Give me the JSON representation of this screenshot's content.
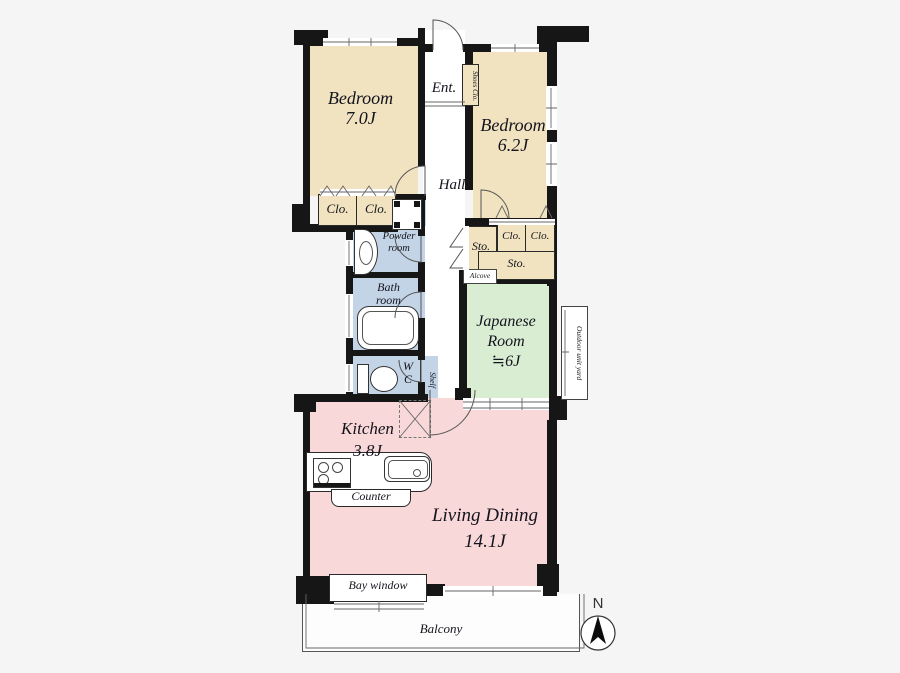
{
  "page": {
    "type": "apartment-floor-plan"
  },
  "colors": {
    "bedroom_beige": "#f1e3c0",
    "wet_area_blue": "#c3d4e6",
    "tatami_green": "#d9edd3",
    "living_pink": "#f8d8d8",
    "wall_black": "#161616",
    "background": "#f5f5f6"
  },
  "labels": {
    "bedroom1_name": "Bedroom",
    "bedroom1_area": "7.0J",
    "bedroom2_name": "Bedroom",
    "bedroom2_area": "6.2J",
    "entrance": "Ent.",
    "shoes_closet": "Shoes Clo.",
    "hall": "Hall",
    "closet": "Clo.",
    "storage": "Sto.",
    "powder_line1": "Powder",
    "powder_line2": "room",
    "bath_line1": "Bath",
    "bath_line2": "room",
    "wc_line1": "W",
    "wc_line2": "C",
    "shelf": "Shelf",
    "alcove": "Alcove",
    "japanese_line1": "Japanese",
    "japanese_line2": "Room",
    "japanese_line3": "≒6J",
    "outdoor_unit_yard": "Outdoor unit yard",
    "kitchen_name": "Kitchen",
    "kitchen_area": "3.8J",
    "counter": "Counter",
    "living_name": "Living Dining",
    "living_area": "14.1J",
    "bay_window": "Bay window",
    "balcony": "Balcony",
    "compass_north": "N"
  },
  "icons": {
    "washing_machine_pan": "square-with-corner-pads",
    "vanity_sink": "half-oval-basin",
    "bathtub": "rounded-rect-tub",
    "toilet": "tank-and-bowl",
    "gas_stove": "square-with-burners",
    "kitchen_sink": "rounded-rect-basin",
    "refrigerator_space": "dashed-cross-square",
    "bifold_door": "zigzag",
    "door_swing": "quarter-arc",
    "compass_needle": "north-triangle"
  }
}
